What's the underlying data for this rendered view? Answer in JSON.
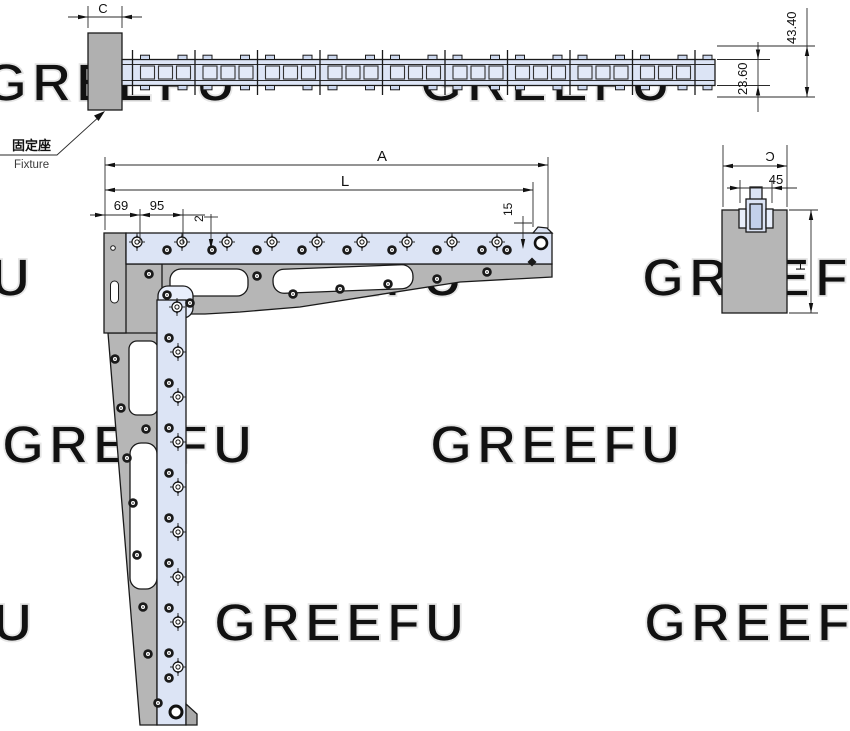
{
  "labels": {
    "dim_c_top": "C",
    "dim_4340": "43.40",
    "dim_2360": "23.60",
    "dim_a": "A",
    "dim_l": "L",
    "dim_69": "69",
    "dim_95": "95",
    "dim_2": "2",
    "dim_15": "15",
    "dim_c_side": "C",
    "dim_45": "45",
    "dim_h": "H",
    "fixture_cn": "固定座",
    "fixture_en": "Fixture"
  },
  "watermarks": {
    "text": "GREEFU",
    "color": "#e5e5e5",
    "positions": [
      [
        -15,
        101
      ],
      [
        420,
        101
      ],
      [
        -220,
        296
      ],
      [
        212,
        296
      ],
      [
        642,
        296
      ],
      [
        2,
        463
      ],
      [
        430,
        463
      ],
      [
        -218,
        641
      ],
      [
        214,
        641
      ],
      [
        644,
        641
      ]
    ]
  },
  "colors": {
    "part_blue": "#dce4f5",
    "part_blue_light": "#e8eefb",
    "part_blue_dark": "#c3d0ea",
    "part_gray": "#b6b6b6",
    "part_gray_dark": "#a9a9a9",
    "line": "#1a1a1a",
    "chain_square": "#e2e9f8",
    "chain_tab": "#cdd8ee"
  },
  "chain": {
    "x0": 122,
    "x1": 715,
    "top": 59.5,
    "bottom": 85.5,
    "inner_top": 64.5,
    "inner_bottom": 80.5,
    "pin_start": 132.5,
    "pin_step": 62.5,
    "pin_count": 10,
    "pin_top": 50,
    "pin_bottom": 95
  },
  "screws": {
    "h_targets": {
      "y": 242,
      "xs": [
        137,
        182,
        227,
        272,
        317,
        362,
        407,
        452,
        497
      ]
    },
    "h_plain": {
      "y": 250,
      "xs": [
        167,
        212,
        257,
        302,
        347,
        392,
        437,
        482,
        507
      ]
    },
    "v_plain": {
      "x": 169,
      "ys": [
        338,
        383,
        428,
        473,
        518,
        563,
        608,
        653,
        678
      ]
    },
    "v_targets": {
      "x": 178,
      "ys": [
        352,
        397,
        442,
        487,
        532,
        577,
        622,
        667
      ]
    },
    "extra_plain": [
      [
        149,
        274
      ],
      [
        257,
        276
      ],
      [
        293,
        294
      ],
      [
        340,
        289
      ],
      [
        388,
        284
      ],
      [
        437,
        279
      ],
      [
        487,
        272
      ],
      [
        115,
        359
      ],
      [
        121,
        408
      ],
      [
        146,
        429
      ],
      [
        127,
        458
      ],
      [
        133,
        503
      ],
      [
        137,
        555
      ],
      [
        143,
        607
      ],
      [
        148,
        654
      ],
      [
        158,
        703
      ],
      [
        167,
        295
      ],
      [
        190,
        303
      ],
      [
        734,
        261
      ],
      [
        777,
        261
      ]
    ],
    "extra_targets": [
      [
        177,
        307
      ],
      [
        733,
        219
      ],
      [
        777,
        219
      ],
      [
        733,
        239
      ],
      [
        777,
        239
      ]
    ],
    "diamonds": [
      [
        532,
        262
      ],
      [
        729,
        250
      ],
      [
        781,
        250
      ]
    ]
  }
}
